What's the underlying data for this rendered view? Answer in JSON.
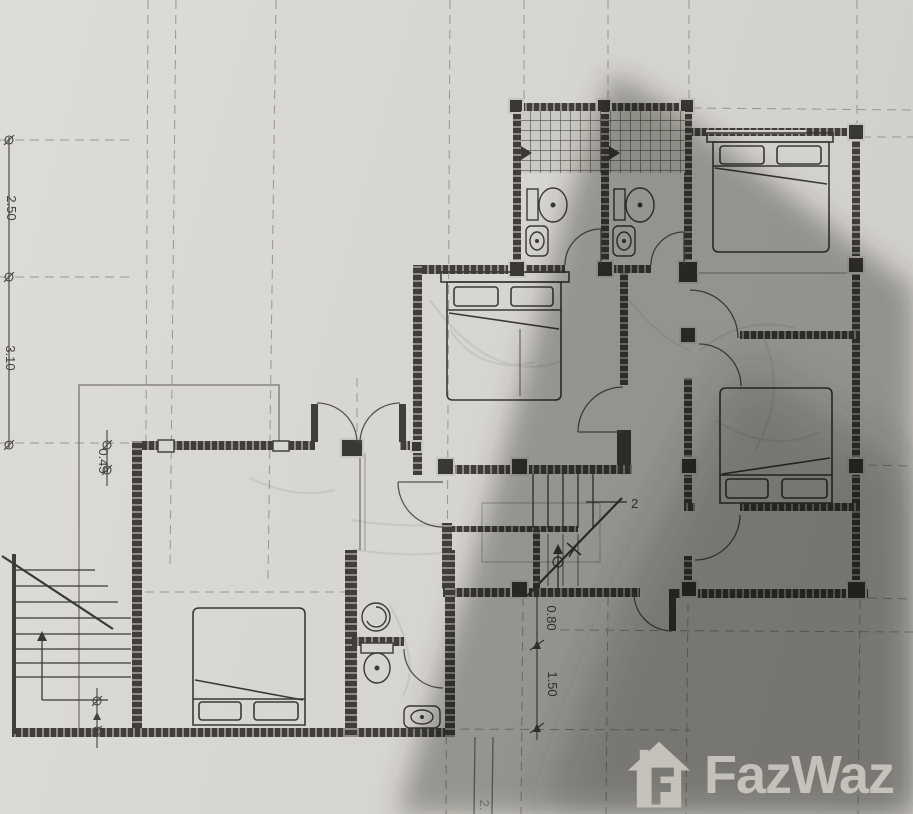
{
  "document": {
    "kind": "scanned floor plan",
    "floor_marker": "2"
  },
  "dimensions": {
    "left_upper": "2.50",
    "left_lower": "3.10",
    "entry_wall": "0.45",
    "stair_upper": "0.80",
    "stair_lower": "1.50"
  },
  "stair_note": {
    "floor_marker": "2"
  },
  "footer_mark": "2.",
  "watermark": {
    "brand": "FazWaz"
  },
  "colors": {
    "paper": "#d9d7d2",
    "ink": "#3f3d39",
    "grid": "#8d8b85",
    "shadow": "#4a4843",
    "watermark_gray": "#cbc8c2"
  },
  "icons": {
    "house_logo": "house-with-f-icon",
    "stair_direction": "up-arrow-icon",
    "shower_head": "shower-head-icon"
  }
}
